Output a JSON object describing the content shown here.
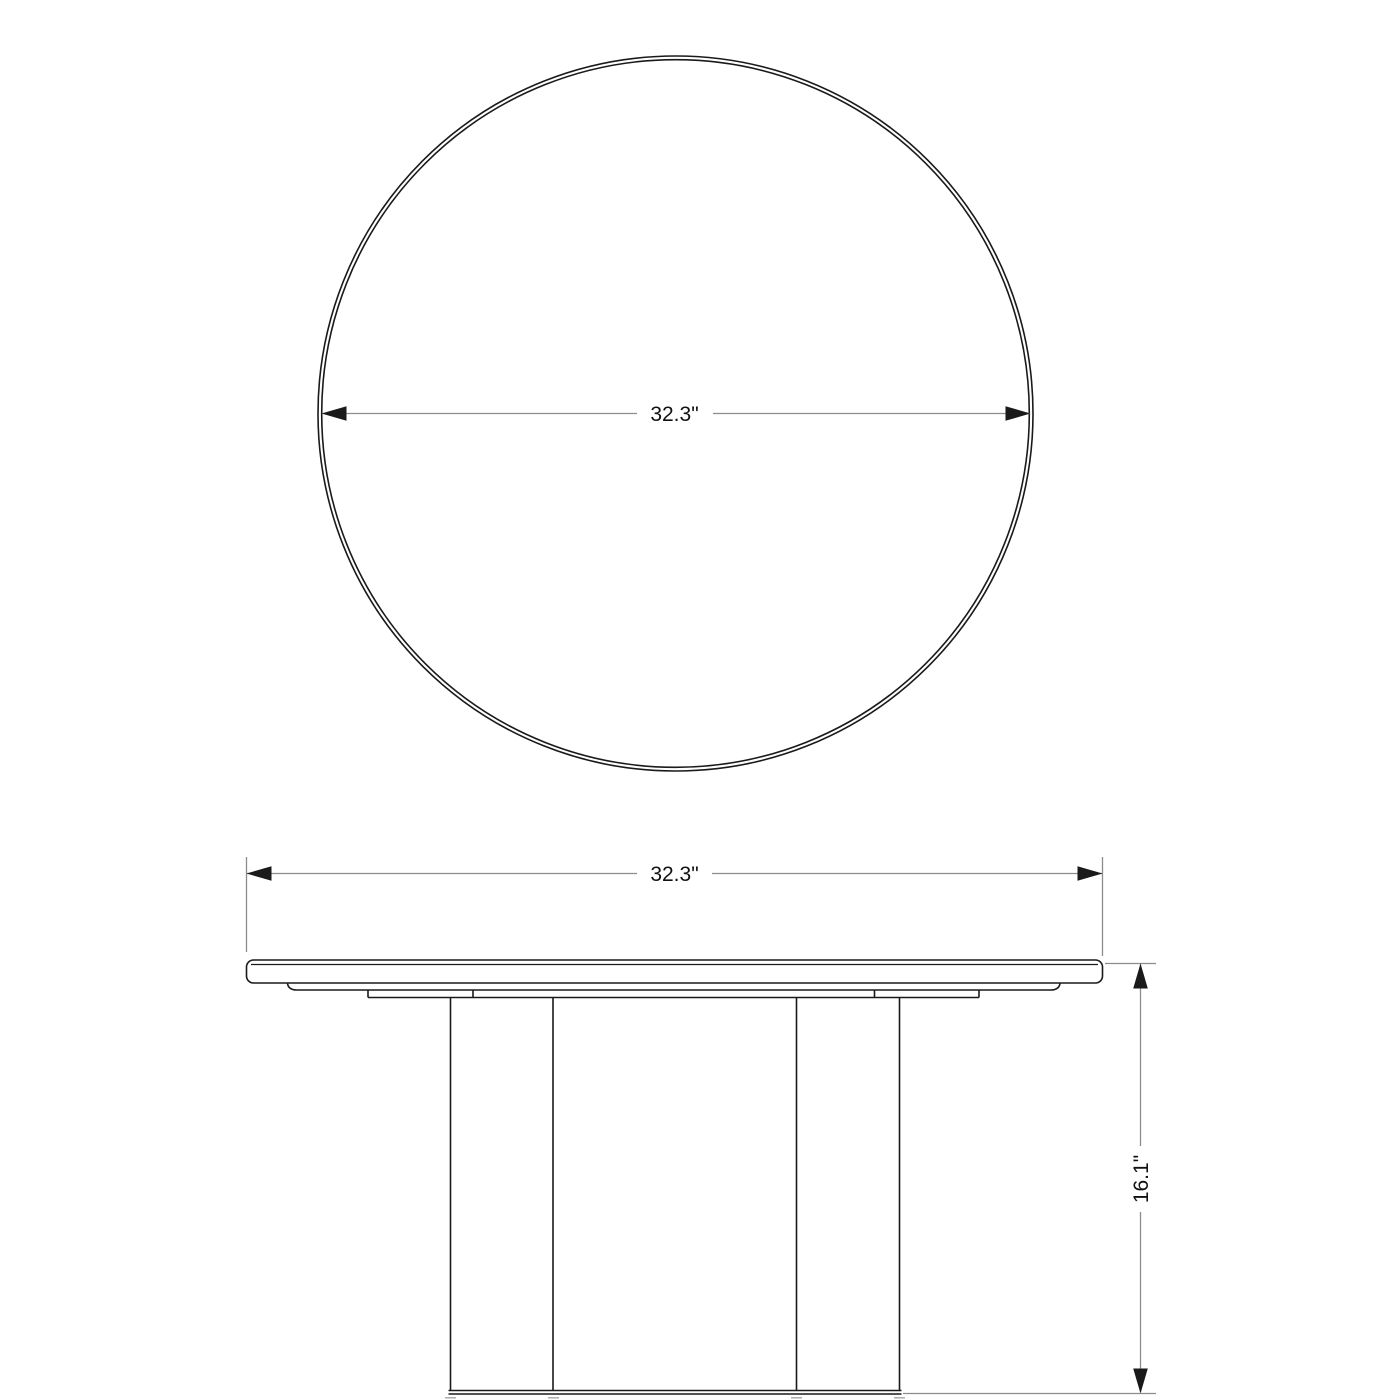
{
  "drawing": {
    "views": {
      "top": {
        "diameter_label": "32.3\""
      },
      "side": {
        "width_label": "32.3\"",
        "height_label": "16.1\""
      }
    },
    "colors": {
      "line": "#1a1a1a",
      "dimension": "#8c8c8c",
      "foot": "#b0b0b0"
    }
  }
}
